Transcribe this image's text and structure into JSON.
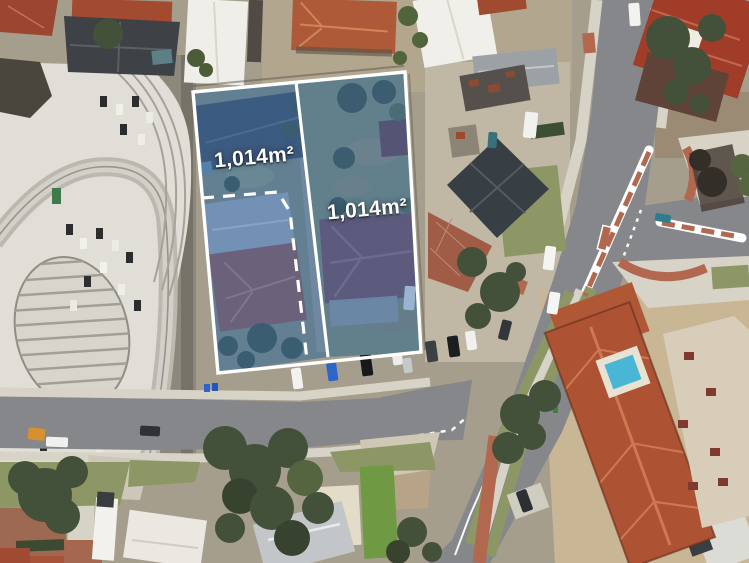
{
  "parcels": {
    "left": {
      "area_label": "1,014m²"
    },
    "right": {
      "area_label": "1,014m²"
    },
    "boundary_color": "#ffffff",
    "overlay_tint": "#3a6fb0"
  },
  "palette": {
    "road_asphalt": "#85878a",
    "footpath_concrete": "#d7d3c6",
    "brick_paving": "#b2674f",
    "grass": "#8d9766",
    "tree_canopy": "#44513a",
    "terracotta_roof": "#ad5233",
    "pool_water": "#4ab6d6"
  }
}
